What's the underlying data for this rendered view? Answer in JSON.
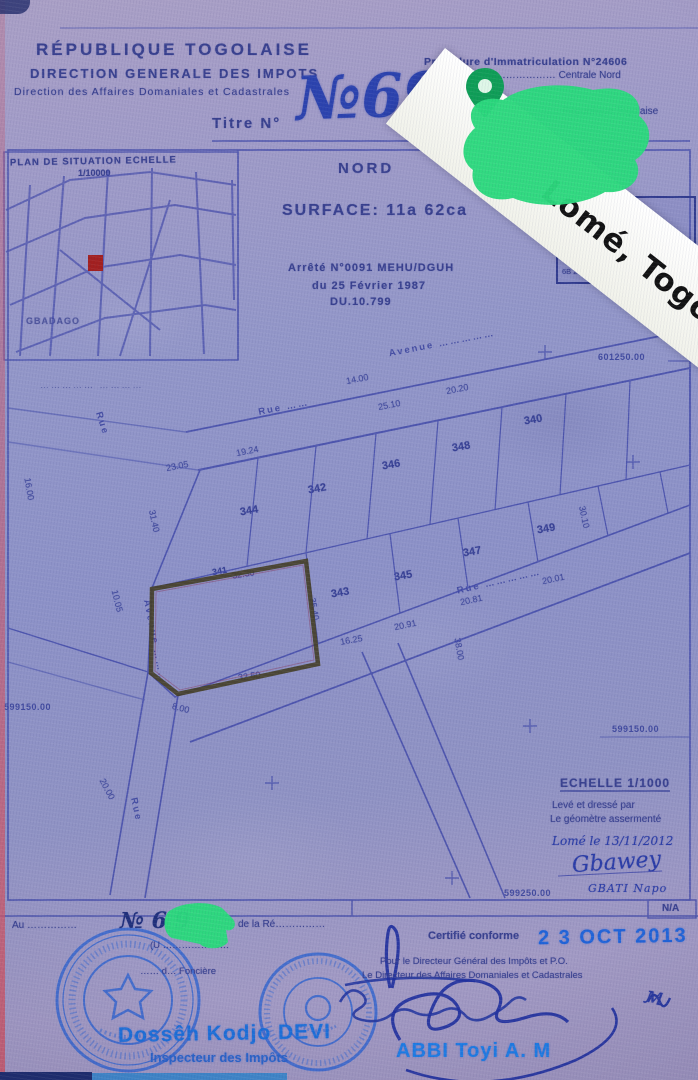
{
  "ribbon": {
    "text": "Lomé, Togo"
  },
  "header": {
    "org1": "RÉPUBLIQUE TOGOLAISE",
    "org2": "DIRECTION GENERALE DES IMPOTS",
    "org3": "Direction des Affaires Domaniales et Cadastrales",
    "titre_label": "Titre N°",
    "titre_number": "№69",
    "proc_line": "Procédure d'Immatriculation N°24606",
    "loc_line": "Lomé ………………………… Centrale Nord",
    "rep_line": "……………………… République Togolaise"
  },
  "map": {
    "title": "PLAN DE SITUATION ECHELLE",
    "scale": "1/10000",
    "place": "GBADAGO",
    "sub": "……………  …………"
  },
  "plan_header": {
    "nord": "NORD",
    "surface": "SURFACE: 11a 62ca",
    "arrete1": "Arrêté N°0091 MEHU/DGUH",
    "arrete2": "du 25 Février 1987",
    "arrete3": "DU.10.799"
  },
  "bornes": {
    "rows": [
      "1B  2991…  6012…",
      "2B  2991…  6012…",
      "3B  2991…  6012…",
      "4B  2991…  6012…",
      "5B  2991…  6012…",
      "6B  2991…  6012…"
    ]
  },
  "plan": {
    "parcels": [
      "348",
      "346",
      "344",
      "342",
      "340",
      "347",
      "345",
      "343",
      "349",
      "341"
    ],
    "dims": [
      "14.00",
      "25.10",
      "19.24",
      "23.05",
      "31.40",
      "16.00",
      "10.05",
      "32.30",
      "32.50",
      "35.40",
      "16.25",
      "20.91",
      "20.81",
      "20.01",
      "38.00",
      "30.10",
      "20.00",
      "8.00",
      "20.20"
    ],
    "streets": [
      "Avenue ……………",
      "Rue",
      "Rue ……",
      "Avenue ………",
      "Rue ……………",
      "Rue"
    ],
    "coord_top": "601250.00",
    "coord_left": "599150.00",
    "coord_right": "599150.00",
    "coord_bottom": "599250.00",
    "scale_label": "ECHELLE 1/1000",
    "surv1": "Levé et dressé par",
    "surv2": "Le géomètre assermenté",
    "surv3": "Lomé le 13/11/2012",
    "sig": "Gbawey",
    "surveyor": "GBATI Napo",
    "na": "N/A"
  },
  "footer": {
    "reg_prefix": "Au ……………",
    "reg_number": "№ 6 9",
    "reg_suffix": "de la Ré……………",
    "note_line": "(U …………………",
    "note_line2": "…… d… Foncière",
    "certifie": "Certifié conforme",
    "date": "2 3 OCT 2013",
    "pour1": "Pour le Directeur Général des Impôts et P.O.",
    "pour2": "Le Directeur des Affaires Domaniales et Cadastrales",
    "left_name": "Dossêh Kodjo DEVI",
    "left_title": "Inspecteur des Impôts",
    "right_name": "ABBI Toyi A. M",
    "mark": "м"
  }
}
